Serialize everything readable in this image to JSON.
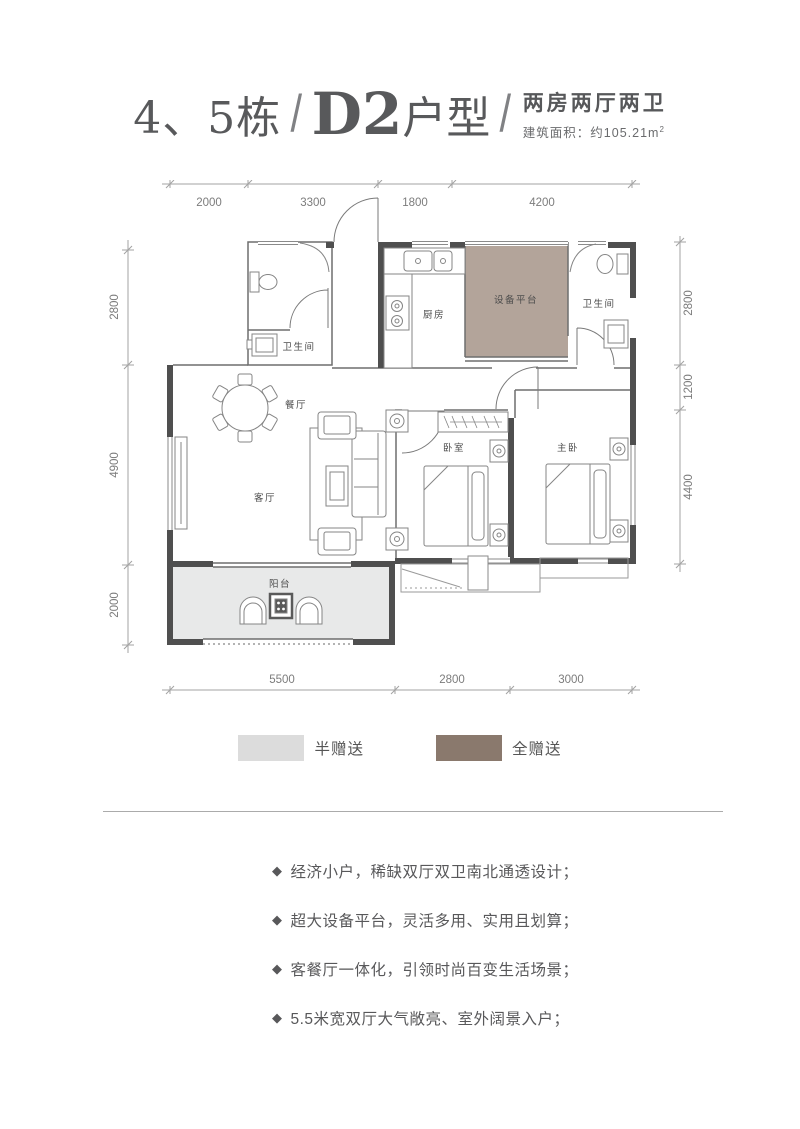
{
  "header": {
    "building": "4、5栋",
    "slash": "/",
    "unit_bold": "D2",
    "unit_rest": "户型",
    "layout_type": "两房两厅两卫",
    "area_prefix": "建筑面积：约",
    "area_value": "105.21",
    "area_unit": "m",
    "area_sup": "2"
  },
  "plan": {
    "rooms": {
      "bath_left": "卫生间",
      "kitchen": "厨房",
      "equipment": "设备平台",
      "bath_right": "卫生间",
      "dining": "餐厅",
      "living": "客厅",
      "bedroom": "卧室",
      "master": "主卧",
      "balcony": "阳台"
    },
    "dims": {
      "top": [
        "2000",
        "3300",
        "1800",
        "4200"
      ],
      "left": [
        "2800",
        "4900",
        "2000"
      ],
      "right": [
        "2800",
        "1200",
        "4400"
      ],
      "bottom": [
        "5500",
        "2800",
        "3000"
      ]
    },
    "colors": {
      "wall": "#4f4f4f",
      "half_gift_area": "#e8e9e9",
      "full_gift_area": "#b3a49a"
    }
  },
  "legend": {
    "items": [
      {
        "label": "半赠送",
        "color": "#dcdcdc"
      },
      {
        "label": "全赠送",
        "color": "#8a796d"
      }
    ]
  },
  "features": {
    "bullet": "◆",
    "items": [
      "经济小户，稀缺双厅双卫南北通透设计；",
      "超大设备平台，灵活多用、实用且划算；",
      "客餐厅一体化，引领时尚百变生活场景；",
      "5.5米宽双厅大气敞亮、室外阔景入户；"
    ]
  }
}
